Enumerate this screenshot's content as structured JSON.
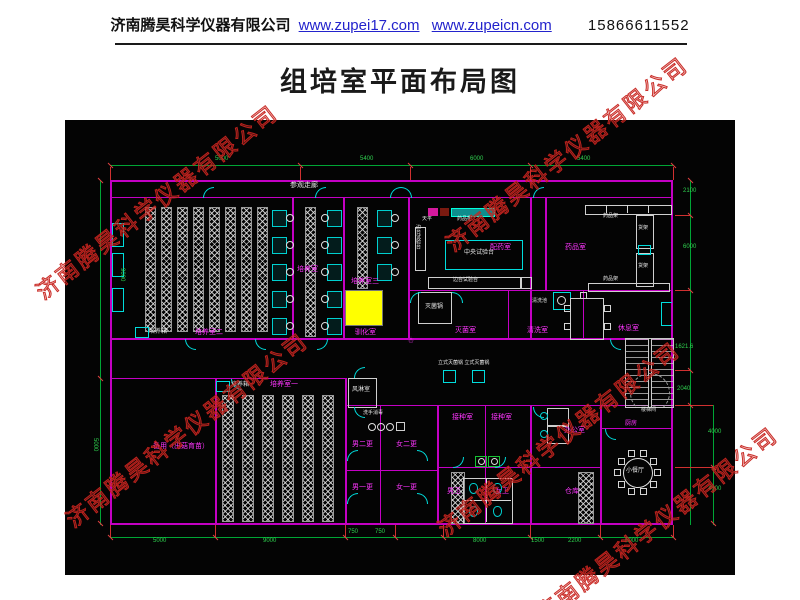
{
  "header": {
    "company": "济南腾昊科学仪器有限公司",
    "link1": "www.zupei17.com",
    "link2": "www.zupeicn.com",
    "phone": "15866611552"
  },
  "title": "组培室平面布局图",
  "watermark": {
    "text": "济南腾昊科学仪器有限公司",
    "instances": [
      {
        "x": 48,
        "y": 300
      },
      {
        "x": 458,
        "y": 252
      },
      {
        "x": 78,
        "y": 528
      },
      {
        "x": 450,
        "y": 537
      },
      {
        "x": 548,
        "y": 622
      }
    ]
  },
  "colors": {
    "wall": "#c400c4",
    "door": "#00dcdc",
    "dimension": "#00a535",
    "room_label": "#ff35ff",
    "equipment_label": "#e8e8e8",
    "highlight_box": "#ffff00",
    "watermark": "#c6231e",
    "link": "#2323cc"
  },
  "plan": {
    "room_labels": [
      {
        "t": "参观走廊",
        "x": 225,
        "y": 62,
        "c": "white",
        "s": 7
      },
      {
        "t": "培养箱",
        "x": 84,
        "y": 209,
        "c": "white",
        "s": 6
      },
      {
        "t": "培养室二",
        "x": 130,
        "y": 209,
        "c": "magenta",
        "s": 7
      },
      {
        "t": "培养室",
        "x": 232,
        "y": 146,
        "c": "magenta",
        "s": 7
      },
      {
        "t": "培养室三",
        "x": 286,
        "y": 158,
        "c": "magenta",
        "s": 7
      },
      {
        "t": "驯化室",
        "x": 290,
        "y": 209,
        "c": "magenta",
        "s": 7
      },
      {
        "t": "配药室",
        "x": 425,
        "y": 124,
        "c": "magenta",
        "s": 7
      },
      {
        "t": "药品室",
        "x": 500,
        "y": 124,
        "c": "magenta",
        "s": 7
      },
      {
        "t": "灭菌室",
        "x": 390,
        "y": 207,
        "c": "magenta",
        "s": 7
      },
      {
        "t": "清洗室",
        "x": 462,
        "y": 207,
        "c": "magenta",
        "s": 7
      },
      {
        "t": "休息室",
        "x": 553,
        "y": 205,
        "c": "magenta",
        "s": 7
      },
      {
        "t": "培养箱",
        "x": 166,
        "y": 262,
        "c": "white",
        "s": 6
      },
      {
        "t": "培养室一",
        "x": 205,
        "y": 261,
        "c": "magenta",
        "s": 7
      },
      {
        "t": "备用（出菇育苗）",
        "x": 88,
        "y": 323,
        "c": "magenta",
        "s": 7
      },
      {
        "t": "风淋室",
        "x": 287,
        "y": 267,
        "c": "white",
        "s": 6
      },
      {
        "t": "洗手消毒",
        "x": 298,
        "y": 291,
        "c": "white",
        "s": 5
      },
      {
        "t": "男二更",
        "x": 287,
        "y": 321,
        "c": "magenta",
        "s": 7
      },
      {
        "t": "女二更",
        "x": 331,
        "y": 321,
        "c": "magenta",
        "s": 7
      },
      {
        "t": "男一更",
        "x": 287,
        "y": 364,
        "c": "magenta",
        "s": 7
      },
      {
        "t": "女一更",
        "x": 331,
        "y": 364,
        "c": "magenta",
        "s": 7
      },
      {
        "t": "接种室",
        "x": 387,
        "y": 294,
        "c": "magenta",
        "s": 7
      },
      {
        "t": "接种室",
        "x": 426,
        "y": 294,
        "c": "magenta",
        "s": 7
      },
      {
        "t": "男卫",
        "x": 382,
        "y": 368,
        "c": "magenta",
        "s": 7
      },
      {
        "t": "女卫",
        "x": 430,
        "y": 368,
        "c": "magenta",
        "s": 7
      },
      {
        "t": "办公室",
        "x": 499,
        "y": 307,
        "c": "magenta",
        "s": 7
      },
      {
        "t": "仓库",
        "x": 500,
        "y": 368,
        "c": "magenta",
        "s": 7
      },
      {
        "t": "厨房",
        "x": 560,
        "y": 301,
        "c": "magenta",
        "s": 6
      },
      {
        "t": "小餐厅",
        "x": 561,
        "y": 348,
        "c": "white",
        "s": 6
      },
      {
        "t": "楼梯间",
        "x": 576,
        "y": 288,
        "c": "white",
        "s": 5
      }
    ],
    "equipment_labels": [
      {
        "t": "中央试验台",
        "x": 399,
        "y": 130,
        "c": "white",
        "s": 6
      },
      {
        "t": "边台试验台",
        "x": 350,
        "y": 104,
        "c": "white",
        "s": 5,
        "v": true
      },
      {
        "t": "边台试验台",
        "x": 388,
        "y": 158,
        "c": "white",
        "s": 5
      },
      {
        "t": "天平",
        "x": 357,
        "y": 97,
        "c": "white",
        "s": 5
      },
      {
        "t": "药品柜",
        "x": 392,
        "y": 97,
        "c": "white",
        "s": 5
      },
      {
        "t": "药品架",
        "x": 538,
        "y": 94,
        "c": "white",
        "s": 5
      },
      {
        "t": "药品架",
        "x": 538,
        "y": 157,
        "c": "white",
        "s": 5
      },
      {
        "t": "货架",
        "x": 573,
        "y": 106,
        "c": "white",
        "s": 5
      },
      {
        "t": "货架",
        "x": 573,
        "y": 144,
        "c": "white",
        "s": 5
      },
      {
        "t": "灭菌锅",
        "x": 360,
        "y": 184,
        "c": "white",
        "s": 6
      },
      {
        "t": "清洗池",
        "x": 467,
        "y": 179,
        "c": "white",
        "s": 5
      },
      {
        "t": "立式灭菌锅 立式灭菌锅",
        "x": 373,
        "y": 241,
        "c": "white",
        "s": 5
      }
    ],
    "dimensions": {
      "top": [
        {
          "v": "5000",
          "x": 150,
          "y": 36
        },
        {
          "v": "5400",
          "x": 295,
          "y": 36
        },
        {
          "v": "6000",
          "x": 405,
          "y": 36
        },
        {
          "v": "5400",
          "x": 512,
          "y": 36
        }
      ],
      "bottom": [
        {
          "v": "5000",
          "x": 88,
          "y": 418
        },
        {
          "v": "9000",
          "x": 198,
          "y": 418
        },
        {
          "v": "750",
          "x": 283,
          "y": 409
        },
        {
          "v": "750",
          "x": 310,
          "y": 409
        },
        {
          "v": "8000",
          "x": 408,
          "y": 418
        },
        {
          "v": "1500",
          "x": 466,
          "y": 418
        },
        {
          "v": "2200",
          "x": 503,
          "y": 418
        },
        {
          "v": "5000",
          "x": 560,
          "y": 418
        }
      ],
      "right": [
        {
          "v": "2100",
          "x": 618,
          "y": 68
        },
        {
          "v": "6000",
          "x": 618,
          "y": 124
        },
        {
          "v": "1621.6",
          "x": 610,
          "y": 224
        },
        {
          "v": "2040",
          "x": 612,
          "y": 266
        },
        {
          "v": "4000",
          "x": 643,
          "y": 309
        },
        {
          "v": "4000",
          "x": 643,
          "y": 366
        }
      ],
      "left": [
        {
          "v": "9000",
          "x": 54,
          "y": 148,
          "v90": true
        },
        {
          "v": "5000",
          "x": 27,
          "y": 318,
          "v90": true
        }
      ]
    }
  }
}
